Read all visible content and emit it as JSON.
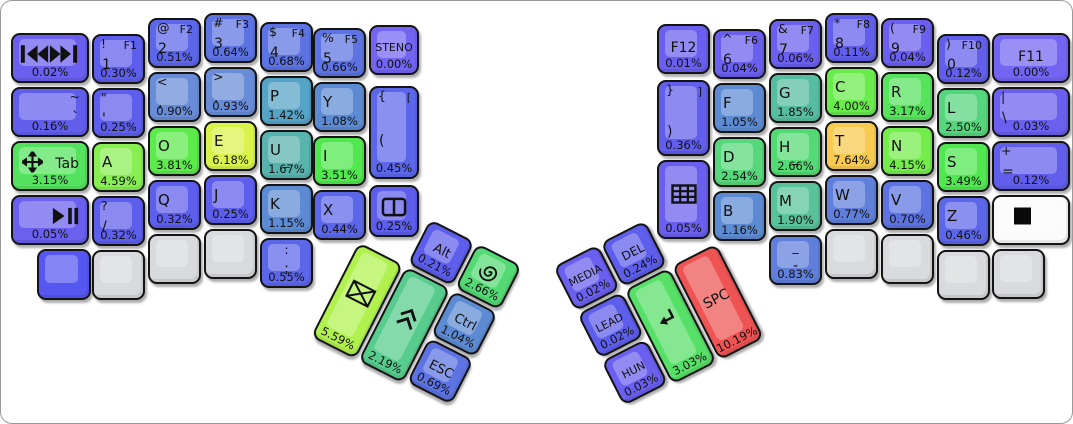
{
  "canvas": {
    "width": 1073,
    "height": 424,
    "background": "#ffffff",
    "frame_border": "#9a9a9a"
  },
  "heat_colors": {
    "zero": "#7464f2",
    "low_blue": "#5e5eec",
    "steel": "#5d8bd3",
    "teal": "#58b2ad",
    "green": "#55d67d",
    "bright_green": "#50e84e",
    "yellow_green": "#b1f14f",
    "yellow": "#daf34b",
    "orange": "#f8ca50",
    "red": "#ee5454",
    "blank_gray": "#d9dadd",
    "blank_blue": "#5557f0",
    "white_key": "#fbfbfb"
  },
  "clusters": {
    "left": {
      "x": 382,
      "y": 194,
      "rot": 27
    },
    "right": {
      "x": 552,
      "y": 266,
      "rot": -27
    }
  },
  "keys": [
    {
      "n": "media-prev-next",
      "icon": "prev-next",
      "pct": "0.02%",
      "color": "#6a5fee",
      "x": 10,
      "y": 32,
      "w": 78,
      "h": 50
    },
    {
      "n": "1",
      "shift": "!",
      "fn": "F1",
      "main": "1",
      "ms": 14,
      "pct": "0.30%",
      "color": "#5e5eec",
      "x": 91,
      "y": 33,
      "w": 53,
      "h": 50
    },
    {
      "n": "2",
      "shift": "@",
      "fn": "F2",
      "main": "2",
      "ms": 14,
      "pct": "0.51%",
      "color": "#5c66e9",
      "x": 147,
      "y": 17,
      "w": 53,
      "h": 50
    },
    {
      "n": "3",
      "shift": "#",
      "fn": "F3",
      "main": "3",
      "ms": 14,
      "pct": "0.64%",
      "color": "#5d73e2",
      "x": 203,
      "y": 12,
      "w": 53,
      "h": 50
    },
    {
      "n": "4",
      "shift": "$",
      "fn": "F4",
      "main": "4",
      "ms": 14,
      "pct": "0.68%",
      "color": "#5d73e2",
      "x": 259,
      "y": 21,
      "w": 53,
      "h": 50
    },
    {
      "n": "5",
      "shift": "%",
      "fn": "F5",
      "main": "5",
      "ms": 14,
      "pct": "0.66%",
      "color": "#5d73e2",
      "x": 312,
      "y": 27,
      "w": 53,
      "h": 50
    },
    {
      "n": "steno",
      "main": "STENO",
      "v": "c",
      "ms": 11,
      "pct": "0.00%",
      "color": "#7464f2",
      "x": 368,
      "y": 24,
      "w": 50,
      "h": 50
    },
    {
      "n": "grave",
      "shift": "~",
      "main": "`",
      "v": "r",
      "ms": 14,
      "pct": "0.16%",
      "color": "#615eec",
      "x": 10,
      "y": 86,
      "w": 78,
      "h": 50
    },
    {
      "n": "quote",
      "shift": "\"",
      "main": "'",
      "ms": 14,
      "pct": "0.25%",
      "color": "#5e5eec",
      "x": 91,
      "y": 87,
      "w": 53,
      "h": 50
    },
    {
      "n": "comma",
      "shift": "<",
      "main": ",",
      "ms": 14,
      "pct": "0.90%",
      "color": "#688cd7",
      "x": 147,
      "y": 71,
      "w": 53,
      "h": 50
    },
    {
      "n": "period",
      "shift": ">",
      "main": ".",
      "ms": 14,
      "pct": "0.93%",
      "color": "#688cd7",
      "x": 203,
      "y": 66,
      "w": 53,
      "h": 50
    },
    {
      "n": "p",
      "main": "P",
      "pct": "1.42%",
      "color": "#55a3c6",
      "x": 259,
      "y": 75,
      "w": 53,
      "h": 50
    },
    {
      "n": "y",
      "main": "Y",
      "pct": "1.08%",
      "color": "#5d8bd3",
      "x": 312,
      "y": 81,
      "w": 53,
      "h": 50
    },
    {
      "n": "lbracket",
      "shift": "{",
      "fn": "[",
      "main": "(",
      "ms": 14,
      "mt": 52,
      "pct": "0.45%",
      "color": "#5c66e9",
      "x": 368,
      "y": 85,
      "w": 50,
      "h": 93
    },
    {
      "n": "tab",
      "icon": "move",
      "main": "Tab",
      "v": "r",
      "ms": 14,
      "mt": 30,
      "pct": "3.15%",
      "color": "#55e35f",
      "x": 10,
      "y": 140,
      "w": 78,
      "h": 50
    },
    {
      "n": "a",
      "main": "A",
      "pct": "4.59%",
      "color": "#87ef52",
      "x": 91,
      "y": 141,
      "w": 53,
      "h": 50
    },
    {
      "n": "o",
      "main": "O",
      "pct": "3.81%",
      "color": "#5dea4b",
      "x": 147,
      "y": 125,
      "w": 53,
      "h": 50
    },
    {
      "n": "e",
      "main": "E",
      "pct": "6.18%",
      "color": "#daf34b",
      "x": 203,
      "y": 120,
      "w": 53,
      "h": 50
    },
    {
      "n": "u",
      "main": "U",
      "sub": "_",
      "pct": "1.67%",
      "color": "#58b2ad",
      "x": 259,
      "y": 129,
      "w": 53,
      "h": 50
    },
    {
      "n": "i",
      "main": "I",
      "pct": "3.51%",
      "color": "#50e84e",
      "x": 312,
      "y": 135,
      "w": 53,
      "h": 50
    },
    {
      "n": "media-play-pause",
      "icon": "play-pause",
      "pct": "0.05%",
      "color": "#6a5fee",
      "x": 10,
      "y": 194,
      "w": 78,
      "h": 50
    },
    {
      "n": "slash",
      "shift": "?",
      "main": "/",
      "ms": 14,
      "pct": "0.32%",
      "color": "#5e5eec",
      "x": 91,
      "y": 195,
      "w": 53,
      "h": 50
    },
    {
      "n": "q",
      "main": "Q",
      "pct": "0.32%",
      "color": "#5e5eec",
      "x": 147,
      "y": 179,
      "w": 53,
      "h": 50
    },
    {
      "n": "j",
      "main": "J",
      "pct": "0.25%",
      "color": "#5e5eec",
      "x": 203,
      "y": 174,
      "w": 53,
      "h": 50
    },
    {
      "n": "k",
      "main": "K",
      "pct": "1.15%",
      "color": "#5d8bd3",
      "x": 259,
      "y": 183,
      "w": 53,
      "h": 50
    },
    {
      "n": "x",
      "main": "X",
      "pct": "0.44%",
      "color": "#5c66e9",
      "x": 312,
      "y": 189,
      "w": 53,
      "h": 50
    },
    {
      "n": "window-layout",
      "icon": "window-split",
      "pct": "0.25%",
      "color": "#5e5eec",
      "x": 368,
      "y": 184,
      "w": 50,
      "h": 52
    },
    {
      "n": "blank-blue",
      "color": "#5557f0",
      "x": 36,
      "y": 248,
      "w": 54,
      "h": 51
    },
    {
      "n": "blank-gray-l1",
      "color": "#d9dadd",
      "x": 91,
      "y": 249,
      "w": 53,
      "h": 50
    },
    {
      "n": "blank-gray-l2",
      "color": "#d9dadd",
      "x": 147,
      "y": 233,
      "w": 53,
      "h": 50
    },
    {
      "n": "blank-gray-l3",
      "color": "#d9dadd",
      "x": 203,
      "y": 228,
      "w": 53,
      "h": 50
    },
    {
      "n": "semicolon",
      "shift": ":",
      "main": ";",
      "v": "c",
      "ms": 14,
      "pct": "0.55%",
      "color": "#5c66e9",
      "x": 259,
      "y": 237,
      "w": 53,
      "h": 50
    },
    {
      "n": "alt",
      "main": "Alt",
      "v": "c",
      "ms": 13,
      "pct": "0.21%",
      "color": "#5e5eec",
      "cl": "left",
      "x": 53,
      "y": 0,
      "w": 50,
      "h": 50
    },
    {
      "n": "super",
      "icon": "spiral",
      "pct": "2.66%",
      "color": "#54da74",
      "cl": "left",
      "x": 106,
      "y": 0,
      "w": 50,
      "h": 50
    },
    {
      "n": "ctrl",
      "main": "Ctrl",
      "v": "c",
      "ms": 13,
      "pct": "1.04%",
      "color": "#5d8bd3",
      "cl": "left",
      "x": 106,
      "y": 53,
      "w": 50,
      "h": 50
    },
    {
      "n": "esc",
      "main": "ESC",
      "v": "c",
      "ms": 13,
      "pct": "0.69%",
      "color": "#5d73e2",
      "cl": "left",
      "x": 106,
      "y": 106,
      "w": 50,
      "h": 50
    },
    {
      "n": "backspace",
      "icon": "envelope",
      "pct": "5.59%",
      "color": "#b1f14f",
      "cl": "left",
      "x": 0,
      "y": 53,
      "w": 50,
      "h": 106
    },
    {
      "n": "shift-thumb",
      "icon": "chevrons-up",
      "pct": "2.19%",
      "color": "#57cc8c",
      "cl": "left",
      "x": 53,
      "y": 53,
      "w": 50,
      "h": 106
    },
    {
      "n": "media-layer",
      "main": "MEDIA",
      "v": "c",
      "ms": 11,
      "pct": "0.02%",
      "color": "#6a5fee",
      "cl": "right",
      "x": 0,
      "y": 0,
      "w": 50,
      "h": 50
    },
    {
      "n": "del",
      "main": "DEL",
      "v": "c",
      "ms": 12,
      "pct": "0.24%",
      "color": "#5e5eec",
      "cl": "right",
      "x": 53,
      "y": 0,
      "w": 50,
      "h": 50
    },
    {
      "n": "lead",
      "main": "LEAD",
      "v": "c",
      "ms": 11,
      "pct": "0.02%",
      "color": "#5e5eec",
      "cl": "right",
      "x": 0,
      "y": 53,
      "w": 50,
      "h": 50
    },
    {
      "n": "hun",
      "main": "HUN",
      "v": "c",
      "ms": 11,
      "pct": "0.03%",
      "color": "#6a5fee",
      "cl": "right",
      "x": 0,
      "y": 106,
      "w": 50,
      "h": 50
    },
    {
      "n": "enter",
      "icon": "enter-arrow",
      "pct": "3.03%",
      "color": "#57e067",
      "cl": "right",
      "x": 53,
      "y": 53,
      "w": 50,
      "h": 106
    },
    {
      "n": "space",
      "main": "SPC",
      "v": "c",
      "ms": 14,
      "mt": 40,
      "pct": "10.19%",
      "color": "#ee5454",
      "cl": "right",
      "x": 106,
      "y": 53,
      "w": 50,
      "h": 106
    },
    {
      "n": "f12",
      "main": "F12",
      "v": "c",
      "ms": 14,
      "pct": "0.01%",
      "color": "#6a5fee",
      "x": 656,
      "y": 23,
      "w": 53,
      "h": 50
    },
    {
      "n": "rbracket",
      "shift": "}",
      "fn": "]",
      "main": ")",
      "ms": 14,
      "mt": 60,
      "pct": "0.36%",
      "color": "#615eec",
      "x": 656,
      "y": 79,
      "w": 53,
      "h": 76
    },
    {
      "n": "keypad-grid",
      "icon": "grid",
      "pct": "0.05%",
      "color": "#6a5fee",
      "x": 656,
      "y": 159,
      "w": 53,
      "h": 79
    },
    {
      "n": "6",
      "shift": "^",
      "fn": "F6",
      "main": "6",
      "ms": 14,
      "pct": "0.04%",
      "color": "#6a5fee",
      "x": 712,
      "y": 28,
      "w": 53,
      "h": 50
    },
    {
      "n": "f",
      "main": "F",
      "pct": "1.05%",
      "color": "#5d8bd3",
      "x": 712,
      "y": 82,
      "w": 53,
      "h": 50
    },
    {
      "n": "d",
      "main": "D",
      "pct": "2.54%",
      "color": "#57d77b",
      "x": 712,
      "y": 136,
      "w": 53,
      "h": 50
    },
    {
      "n": "b",
      "main": "B",
      "pct": "1.16%",
      "color": "#5d8bd3",
      "x": 712,
      "y": 190,
      "w": 53,
      "h": 50
    },
    {
      "n": "7",
      "shift": "&",
      "fn": "F7",
      "main": "7",
      "ms": 14,
      "pct": "0.06%",
      "color": "#6a5fee",
      "x": 768,
      "y": 18,
      "w": 53,
      "h": 50
    },
    {
      "n": "g",
      "main": "G",
      "pct": "1.85%",
      "color": "#57bda0",
      "x": 768,
      "y": 72,
      "w": 53,
      "h": 50
    },
    {
      "n": "h",
      "main": "H",
      "sub": "_",
      "pct": "2.66%",
      "color": "#54da74",
      "x": 768,
      "y": 126,
      "w": 53,
      "h": 50
    },
    {
      "n": "m",
      "main": "M",
      "pct": "1.90%",
      "color": "#58c29a",
      "x": 768,
      "y": 180,
      "w": 53,
      "h": 50
    },
    {
      "n": "minus",
      "shift": "_",
      "main": "-",
      "v": "c",
      "ms": 14,
      "pct": "0.83%",
      "color": "#607fdb",
      "x": 768,
      "y": 234,
      "w": 53,
      "h": 50
    },
    {
      "n": "8",
      "shift": "*",
      "fn": "F8",
      "main": "8",
      "ms": 14,
      "pct": "0.11%",
      "color": "#615eec",
      "x": 824,
      "y": 12,
      "w": 53,
      "h": 50
    },
    {
      "n": "c",
      "main": "C",
      "pct": "4.00%",
      "color": "#69ec4b",
      "x": 824,
      "y": 66,
      "w": 53,
      "h": 50
    },
    {
      "n": "t",
      "main": "T",
      "pct": "7.64%",
      "color": "#f8ca50",
      "x": 824,
      "y": 120,
      "w": 53,
      "h": 50
    },
    {
      "n": "w",
      "main": "W",
      "pct": "0.77%",
      "color": "#607fdb",
      "x": 824,
      "y": 174,
      "w": 53,
      "h": 50
    },
    {
      "n": "blank-gray-r1",
      "color": "#d9dadd",
      "x": 824,
      "y": 228,
      "w": 53,
      "h": 50
    },
    {
      "n": "9",
      "shift": "(",
      "fn": "F9",
      "main": "9",
      "ms": 14,
      "pct": "0.04%",
      "color": "#6a5fee",
      "x": 880,
      "y": 17,
      "w": 53,
      "h": 50
    },
    {
      "n": "r",
      "main": "R",
      "pct": "3.17%",
      "color": "#56e45d",
      "x": 880,
      "y": 71,
      "w": 53,
      "h": 50
    },
    {
      "n": "n",
      "main": "N",
      "pct": "4.15%",
      "color": "#74ed4c",
      "x": 880,
      "y": 125,
      "w": 53,
      "h": 50
    },
    {
      "n": "v",
      "main": "V",
      "pct": "0.70%",
      "color": "#5d73e2",
      "x": 880,
      "y": 179,
      "w": 53,
      "h": 50
    },
    {
      "n": "blank-gray-r2",
      "color": "#d9dadd",
      "x": 880,
      "y": 233,
      "w": 53,
      "h": 50
    },
    {
      "n": "0",
      "shift": ")",
      "fn": "F10",
      "main": "0",
      "ms": 14,
      "pct": "0.12%",
      "color": "#615eec",
      "x": 936,
      "y": 33,
      "w": 53,
      "h": 50
    },
    {
      "n": "l",
      "main": "L",
      "pct": "2.50%",
      "color": "#55d67d",
      "x": 936,
      "y": 87,
      "w": 53,
      "h": 50
    },
    {
      "n": "s",
      "main": "S",
      "pct": "3.49%",
      "color": "#50e750",
      "x": 936,
      "y": 141,
      "w": 53,
      "h": 50
    },
    {
      "n": "z",
      "main": "Z",
      "pct": "0.46%",
      "color": "#5c66e9",
      "x": 936,
      "y": 195,
      "w": 53,
      "h": 50
    },
    {
      "n": "blank-gray-r3",
      "color": "#d9dadd",
      "x": 936,
      "y": 249,
      "w": 53,
      "h": 50
    },
    {
      "n": "f11",
      "main": "F11",
      "v": "c",
      "ms": 14,
      "pct": "0.00%",
      "color": "#7464f2",
      "x": 991,
      "y": 32,
      "w": 78,
      "h": 50
    },
    {
      "n": "backslash",
      "shift": "|",
      "main": "\\",
      "ms": 14,
      "pct": "0.03%",
      "color": "#6a5fee",
      "x": 991,
      "y": 86,
      "w": 78,
      "h": 50
    },
    {
      "n": "equals",
      "shift": "+",
      "main": "=",
      "ms": 14,
      "pct": "0.12%",
      "color": "#615eec",
      "x": 991,
      "y": 140,
      "w": 78,
      "h": 50
    },
    {
      "n": "white-square-key",
      "icon": "black-square",
      "color": "#fbfbfb",
      "x": 991,
      "y": 194,
      "w": 78,
      "h": 50
    },
    {
      "n": "blank-gray-r4",
      "color": "#d9dadd",
      "x": 991,
      "y": 248,
      "w": 53,
      "h": 50
    }
  ]
}
